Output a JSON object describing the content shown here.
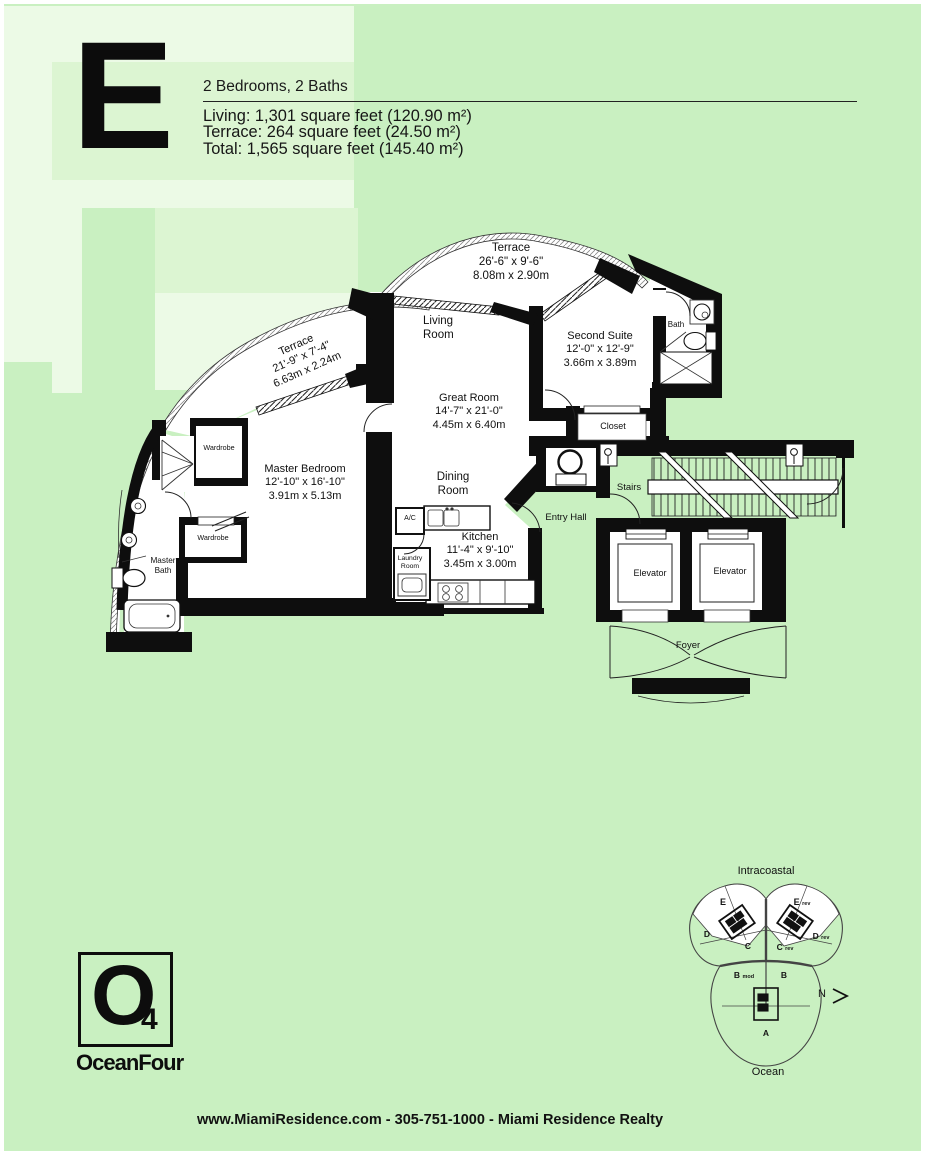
{
  "header": {
    "unit_letter": "E",
    "subtitle": "2 Bedrooms, 2 Baths",
    "stats": [
      "Living: 1,301 square feet (120.90 m²)",
      "Terrace: 264 square feet (24.50 m²)",
      "Total: 1,565 square feet (145.40 m²)"
    ]
  },
  "floorplan": {
    "terrace_top": {
      "lines": [
        "Terrace",
        "26'-6\" x 9'-6\"",
        "8.08m x 2.90m"
      ]
    },
    "terrace_left": {
      "lines": [
        "Terrace",
        "21'-9\" x 7'-4\"",
        "6.63m x 2.24m"
      ]
    },
    "living": {
      "lines": [
        "Living",
        "Room"
      ]
    },
    "second_suite": {
      "lines": [
        "Second Suite",
        "12'-0\" x 12'-9\"",
        "3.66m x 3.89m"
      ]
    },
    "bath": {
      "lines": [
        "Bath"
      ]
    },
    "great_room": {
      "lines": [
        "Great Room",
        "14'-7\" x 21'-0\"",
        "4.45m x 6.40m"
      ]
    },
    "closet": {
      "lines": [
        "Closet"
      ]
    },
    "master_bedroom": {
      "lines": [
        "Master Bedroom",
        "12'-10\" x 16'-10\"",
        "3.91m x 5.13m"
      ]
    },
    "wardrobe_upper": {
      "lines": [
        "Wardrobe"
      ]
    },
    "wardrobe_lower": {
      "lines": [
        "Wardrobe"
      ]
    },
    "master_bath": {
      "lines": [
        "Master",
        "Bath"
      ]
    },
    "dining": {
      "lines": [
        "Dining",
        "Room"
      ]
    },
    "ac": {
      "lines": [
        "A/C"
      ]
    },
    "kitchen": {
      "lines": [
        "Kitchen",
        "11'-4\" x 9'-10\"",
        "3.45m x 3.00m"
      ]
    },
    "laundry": {
      "lines": [
        "Laundry",
        "Room"
      ]
    },
    "entry_hall": {
      "lines": [
        "Entry Hall"
      ]
    },
    "stairs": {
      "lines": [
        "Stairs"
      ]
    },
    "elevator_left": {
      "lines": [
        "Elevator"
      ]
    },
    "elevator_right": {
      "lines": [
        "Elevator"
      ]
    },
    "foyer": {
      "lines": [
        "Foyer"
      ]
    }
  },
  "keyplan": {
    "top_label": "Intracoastal",
    "bottom_label": "Ocean",
    "north": "N",
    "units": {
      "e": {
        "main": "E",
        "suffix": ""
      },
      "e_rev": {
        "main": "E",
        "suffix": "rev"
      },
      "d": {
        "main": "D",
        "suffix": ""
      },
      "d_rev": {
        "main": "D",
        "suffix": "rev"
      },
      "c": {
        "main": "C",
        "suffix": ""
      },
      "c_rev": {
        "main": "C",
        "suffix": "rev"
      },
      "b_mod": {
        "main": "B",
        "suffix": "mod"
      },
      "b": {
        "main": "B",
        "suffix": ""
      },
      "a": {
        "main": "A",
        "suffix": ""
      }
    }
  },
  "logo": {
    "symbol": "O",
    "subscript": "4",
    "name": "OceanFour"
  },
  "footer": {
    "text": "www.MiamiResidence.com  -  305-751-1000  -  Miami Residence Realty"
  },
  "colors": {
    "page_green": "#c9f0c1",
    "watermark_light": "#dcf5d2",
    "watermark_lightest": "#ecfae6",
    "ink": "#111111"
  }
}
